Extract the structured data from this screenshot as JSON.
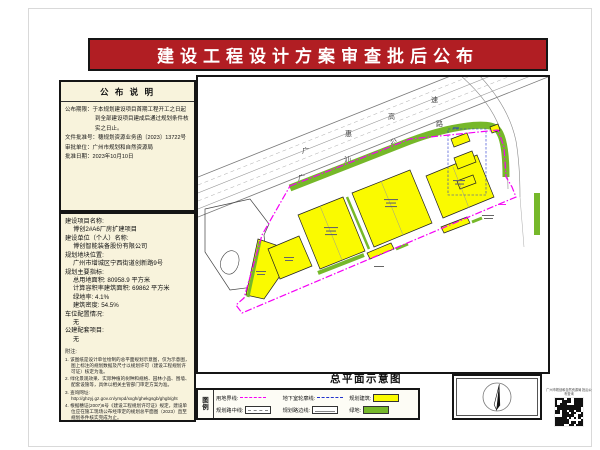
{
  "page": {
    "title": "建设工程设计方案审查批后公布"
  },
  "announcement": {
    "header": "公 布 说 明",
    "lines": [
      {
        "label": "公布期限：",
        "text": "于本规划建设项目首期工程开工之日起到全部建设项目建成后通过规划条件核实之日止。"
      },
      {
        "label": "文件批准号：",
        "text": "穗规划资源业务函〔2023〕13722号"
      },
      {
        "label": "审批单位：",
        "text": "广州市规划和自然资源局"
      },
      {
        "label": "批准日期：",
        "text": "2023年10月10日"
      }
    ]
  },
  "project": {
    "lines": [
      {
        "t": "建设项目名称:",
        "ind": false
      },
      {
        "t": "博创2#A6厂房扩建项目",
        "ind": true
      },
      {
        "t": "建设单位（个人）名称:",
        "ind": false
      },
      {
        "t": "博创智能装备股份有限公司",
        "ind": true
      },
      {
        "t": "规划地块位置:",
        "ind": false
      },
      {
        "t": "广州市增城区宁西街道创新路9号",
        "ind": true
      },
      {
        "t": "规划主要指标:",
        "ind": false
      },
      {
        "t": "总用地面积: 80958.9 平方米",
        "ind": true
      },
      {
        "t": "计算容积率建筑面积: 69862 平方米",
        "ind": true
      },
      {
        "t": "绿地率: 4.1%",
        "ind": true
      },
      {
        "t": "建筑密度: 54.5%",
        "ind": true
      },
      {
        "t": "车位配置情况:",
        "ind": false
      },
      {
        "t": "无",
        "ind": true
      },
      {
        "t": "公建配套项目:",
        "ind": false
      },
      {
        "t": "无",
        "ind": true
      }
    ]
  },
  "notes": {
    "header": "附注:",
    "items": [
      "1. 该图纸是设计单位绘制的总平面规划示意图，仅为示意图，图上标注的规划数据及尺寸以规划许可（建设工程规划许可证）核定为准。",
      "2. 绿化景观效果、实际种植的树种和规格、园林小品、围墙、配套设施等，具体以相关主管部门审定方案为准。",
      "3. 查询网址:\nhttp://ghzyj.gz.gov.cn/ympd/xxgh/ghekgsgb/ghgb/ght",
      "4. 根据穗证(2007)6号《建设工程规划许可证》规定，建设单位应在施工现场公布经审定的规划总平面图（2023）直至规划条件核实完成为止。"
    ]
  },
  "map": {
    "road1": "广惠高速",
    "road2": "广汕公路",
    "plan_title": "总平面示意图"
  },
  "legend": {
    "title_chars": [
      "图",
      "例"
    ],
    "rows": [
      [
        {
          "label": "用地界线:",
          "swatch": "boundary"
        },
        {
          "label": "地下室轮廓线:",
          "swatch": "basement"
        },
        {
          "label": "规划建筑:",
          "swatch": "building"
        }
      ],
      [
        {
          "label": "规划路中线:",
          "swatch": "roadcenter"
        },
        {
          "label": "规划路边线:",
          "swatch": "roadedge"
        },
        {
          "label": "绿地:",
          "swatch": "green"
        }
      ]
    ]
  },
  "qr": {
    "caption": "广州市规划和自然资源局 批后公布查询"
  },
  "colors": {
    "title_red": "#B11E23",
    "panel_cream": "#F8F3DC",
    "building_yellow": "#FAFA00",
    "green": "#76B82A",
    "boundary_magenta": "#F500F5",
    "basement_blue": "#2233CC"
  }
}
